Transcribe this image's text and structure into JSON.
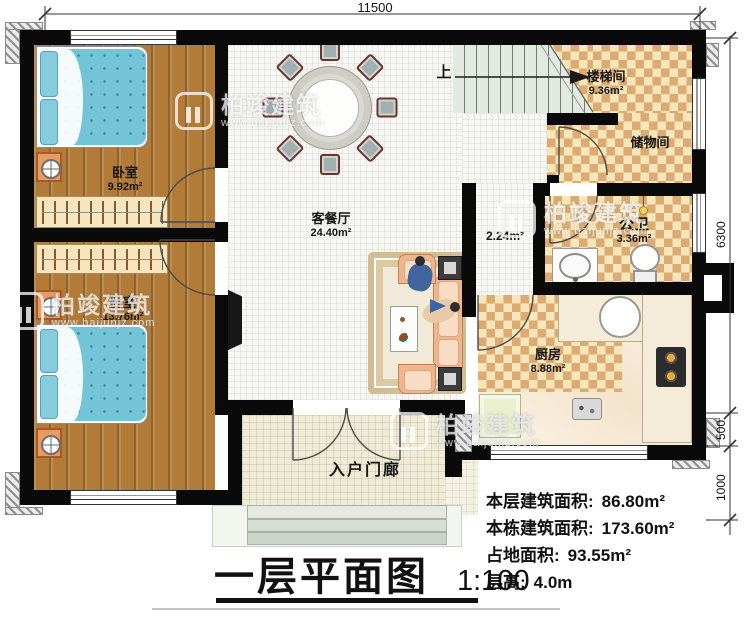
{
  "plan": {
    "title": "一层平面图",
    "scale": "1:100",
    "dimensions": {
      "top": "11500",
      "right_main": "6300",
      "right_mid": "500",
      "right_bottom": "1000"
    },
    "rooms": {
      "bedroom1": {
        "name": "卧室",
        "area": "9.92m²"
      },
      "bedroom2": {
        "name": "卧室",
        "area": "13.76m²"
      },
      "living": {
        "name": "客餐厅",
        "area": "24.40m²"
      },
      "stairwell": {
        "name": "楼梯间",
        "area": "9.36m²",
        "direction": "上"
      },
      "storage": {
        "name": "储物间"
      },
      "bathroom": {
        "name": "公卫",
        "area": "3.36m²"
      },
      "hallway": {
        "area": "2.24m²"
      },
      "kitchen": {
        "name": "厨房",
        "area": "8.88m²"
      },
      "porch": {
        "name": "入户门廊"
      }
    },
    "info": [
      {
        "label": "本层建筑面积:",
        "value": "86.80m²"
      },
      {
        "label": "本栋建筑面积:",
        "value": "173.60m²"
      },
      {
        "label": "占地面积:",
        "value": "93.55m²"
      },
      {
        "label": "层高:",
        "value": "4.0m"
      }
    ],
    "watermark": {
      "brand": "柏竣建筑",
      "url": "www.baijunjz.com"
    },
    "colors": {
      "wall": "#0a0a0a",
      "wood_floor": "#b27c38",
      "checker_dark": "#dcab72",
      "checker_light": "#f6e6bb",
      "quilt": "#74c4d8",
      "sofa": "#f0b48e",
      "counter": "#f4ecd8",
      "stairs": "#e2e9e1"
    }
  }
}
